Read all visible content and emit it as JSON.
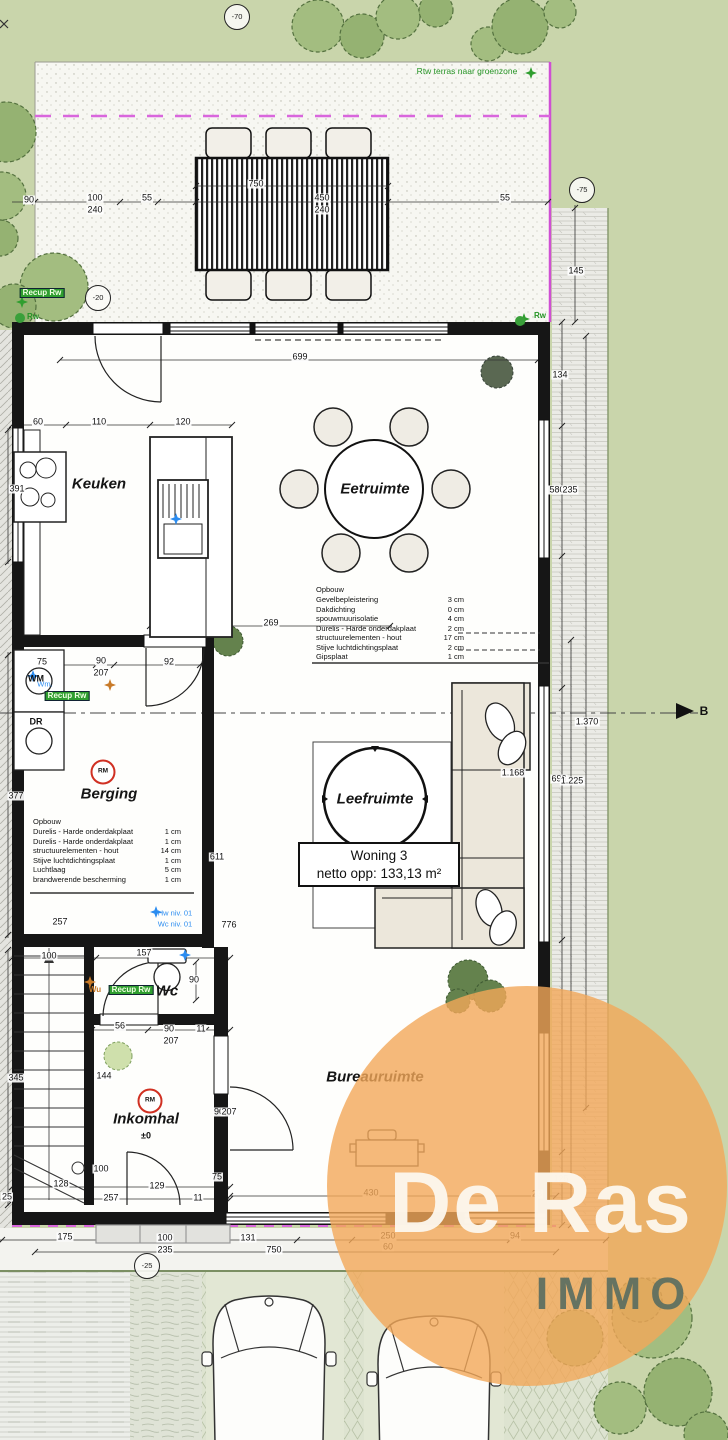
{
  "plan": {
    "unit_box": {
      "line1": "Woning 3",
      "line2": "netto opp: 133,13 m²"
    },
    "watermark": {
      "line1": "De Ras",
      "line2": "IMMO"
    },
    "terrace_note": "Rtw terras naar groenzone",
    "rooms": [
      {
        "name": "Keuken",
        "x": 99,
        "y": 484
      },
      {
        "name": "Eetruimte",
        "x": 375,
        "y": 489
      },
      {
        "name": "Berging",
        "x": 109,
        "y": 794
      },
      {
        "name": "Leefruimte",
        "x": 375,
        "y": 799
      },
      {
        "name": "Wc",
        "x": 167,
        "y": 991
      },
      {
        "name": "Inkomhal",
        "x": 146,
        "y": 1119
      },
      {
        "name": "Bureauruimte",
        "x": 375,
        "y": 1077
      }
    ],
    "buildup_exterior": {
      "title": "Opbouw",
      "rows": [
        {
          "name": "Gevelbepleistering",
          "value": "3 cm"
        },
        {
          "name": "Dakdichting",
          "value": "0 cm"
        },
        {
          "name": "spouwmuurisolatie",
          "value": "4 cm"
        },
        {
          "name": "Durelis - Harde onderdakplaat",
          "value": "2 cm"
        },
        {
          "name": "structuurelementen - hout",
          "value": "17 cm"
        },
        {
          "name": "Stijve luchtdichtingsplaat",
          "value": "2 cm"
        },
        {
          "name": "Gipsplaat",
          "value": "1 cm"
        }
      ]
    },
    "buildup_interior": {
      "title": "Opbouw",
      "rows": [
        {
          "name": "Durelis - Harde onderdakplaat",
          "value": "1 cm"
        },
        {
          "name": "Durelis - Harde onderdakplaat",
          "value": "1 cm"
        },
        {
          "name": "structuurelementen - hout",
          "value": "14 cm"
        },
        {
          "name": "Stijve luchtdichtingsplaat",
          "value": "1 cm"
        },
        {
          "name": "Luchtlaag",
          "value": "5 cm"
        },
        {
          "name": "brandwerende bescherming",
          "value": "1 cm"
        }
      ]
    },
    "green_labels": [
      {
        "t": "Recup Rw",
        "x": 42,
        "y": 293,
        "boxed": true
      },
      {
        "t": "Rw",
        "x": 33,
        "y": 317
      },
      {
        "t": "Rw",
        "x": 540,
        "y": 316
      },
      {
        "t": "Recup Rw",
        "x": 67,
        "y": 696,
        "boxed": true
      },
      {
        "t": "Recup Rw",
        "x": 131,
        "y": 990,
        "boxed": true
      }
    ],
    "blue_labels": [
      {
        "t": "Wm.",
        "x": 45,
        "y": 684
      },
      {
        "t": "Hw niv. 01",
        "x": 175,
        "y": 913
      },
      {
        "t": "Wc niv. 01",
        "x": 175,
        "y": 924
      }
    ],
    "orange_labels": [
      {
        "t": "Wu",
        "x": 95,
        "y": 990
      }
    ],
    "level_markers": [
      {
        "t": "-70",
        "x": 237,
        "y": 17
      },
      {
        "t": "-75",
        "x": 582,
        "y": 190
      },
      {
        "t": "-20",
        "x": 98,
        "y": 298
      },
      {
        "t": "-25",
        "x": 147,
        "y": 1266
      }
    ],
    "rm_markers": [
      {
        "t": "RM",
        "x": 103,
        "y": 772
      },
      {
        "t": "RM",
        "x": 150,
        "y": 1101
      }
    ],
    "small_labels": [
      {
        "t": "WM",
        "x": 36,
        "y": 679,
        "r": 1
      },
      {
        "t": "DR",
        "x": 36,
        "y": 722,
        "r": 1
      },
      {
        "t": "±0",
        "x": 146,
        "y": 1136
      },
      {
        "t": "B",
        "x": 704,
        "y": 711,
        "b": 1
      }
    ],
    "dimensions": [
      {
        "v": "90",
        "x": 29,
        "y": 200
      },
      {
        "v": "100",
        "x": 95,
        "y": 198
      },
      {
        "v": "240",
        "x": 95,
        "y": 210
      },
      {
        "v": "55",
        "x": 147,
        "y": 198
      },
      {
        "v": "750",
        "x": 256,
        "y": 184
      },
      {
        "v": "450",
        "x": 322,
        "y": 198
      },
      {
        "v": "240",
        "x": 322,
        "y": 210
      },
      {
        "v": "55",
        "x": 505,
        "y": 198
      },
      {
        "v": "145",
        "x": 576,
        "y": 271,
        "r": 1
      },
      {
        "v": "699",
        "x": 300,
        "y": 357
      },
      {
        "v": "60",
        "x": 38,
        "y": 422
      },
      {
        "v": "110",
        "x": 99,
        "y": 422
      },
      {
        "v": "120",
        "x": 183,
        "y": 422
      },
      {
        "v": "391",
        "x": 17,
        "y": 489,
        "r": 1
      },
      {
        "v": "134",
        "x": 560,
        "y": 375,
        "r": 1
      },
      {
        "v": "580",
        "x": 557,
        "y": 490,
        "r": 1
      },
      {
        "v": "235",
        "x": 570,
        "y": 490,
        "r": 1
      },
      {
        "v": "269",
        "x": 271,
        "y": 623
      },
      {
        "v": "75",
        "x": 42,
        "y": 662
      },
      {
        "v": "90",
        "x": 101,
        "y": 661
      },
      {
        "v": "207",
        "x": 101,
        "y": 673
      },
      {
        "v": "92",
        "x": 169,
        "y": 662
      },
      {
        "v": "377",
        "x": 16,
        "y": 796,
        "r": 1
      },
      {
        "v": "611",
        "x": 217,
        "y": 857,
        "r": 1
      },
      {
        "v": "1.168",
        "x": 513,
        "y": 773,
        "r": 1
      },
      {
        "v": "1.370",
        "x": 587,
        "y": 722,
        "r": 1
      },
      {
        "v": "696",
        "x": 559,
        "y": 779,
        "r": 1
      },
      {
        "v": "1.225",
        "x": 572,
        "y": 781,
        "r": 1
      },
      {
        "v": "257",
        "x": 60,
        "y": 922
      },
      {
        "v": "776",
        "x": 229,
        "y": 925,
        "r": 1
      },
      {
        "v": "100",
        "x": 49,
        "y": 956
      },
      {
        "v": "157",
        "x": 144,
        "y": 953
      },
      {
        "v": "90",
        "x": 194,
        "y": 980,
        "r": 1
      },
      {
        "v": "56",
        "x": 120,
        "y": 1026
      },
      {
        "v": "90",
        "x": 169,
        "y": 1029
      },
      {
        "v": "207",
        "x": 171,
        "y": 1041
      },
      {
        "v": "11",
        "x": 201,
        "y": 1029
      },
      {
        "v": "144",
        "x": 104,
        "y": 1076,
        "r": 1
      },
      {
        "v": "345",
        "x": 16,
        "y": 1078,
        "r": 1
      },
      {
        "v": "90",
        "x": 219,
        "y": 1112,
        "r": 1
      },
      {
        "v": "207",
        "x": 229,
        "y": 1112,
        "r": 1
      },
      {
        "v": "100",
        "x": 101,
        "y": 1169,
        "r": 1
      },
      {
        "v": "128",
        "x": 61,
        "y": 1184
      },
      {
        "v": "129",
        "x": 157,
        "y": 1186
      },
      {
        "v": "257",
        "x": 111,
        "y": 1198
      },
      {
        "v": "11",
        "x": 198,
        "y": 1198
      },
      {
        "v": "25",
        "x": 7,
        "y": 1197
      },
      {
        "v": "75",
        "x": 217,
        "y": 1177,
        "r": 1
      },
      {
        "v": "430",
        "x": 371,
        "y": 1193
      },
      {
        "v": "23",
        "x": 537,
        "y": 1194
      },
      {
        "v": "125",
        "x": 561,
        "y": 1179,
        "r": 1
      },
      {
        "v": "175",
        "x": 65,
        "y": 1237
      },
      {
        "v": "100",
        "x": 165,
        "y": 1238
      },
      {
        "v": "235",
        "x": 165,
        "y": 1250
      },
      {
        "v": "131",
        "x": 248,
        "y": 1238
      },
      {
        "v": "750",
        "x": 274,
        "y": 1250
      },
      {
        "v": "250",
        "x": 388,
        "y": 1236
      },
      {
        "v": "60",
        "x": 388,
        "y": 1247
      },
      {
        "v": "94",
        "x": 515,
        "y": 1236
      }
    ]
  }
}
